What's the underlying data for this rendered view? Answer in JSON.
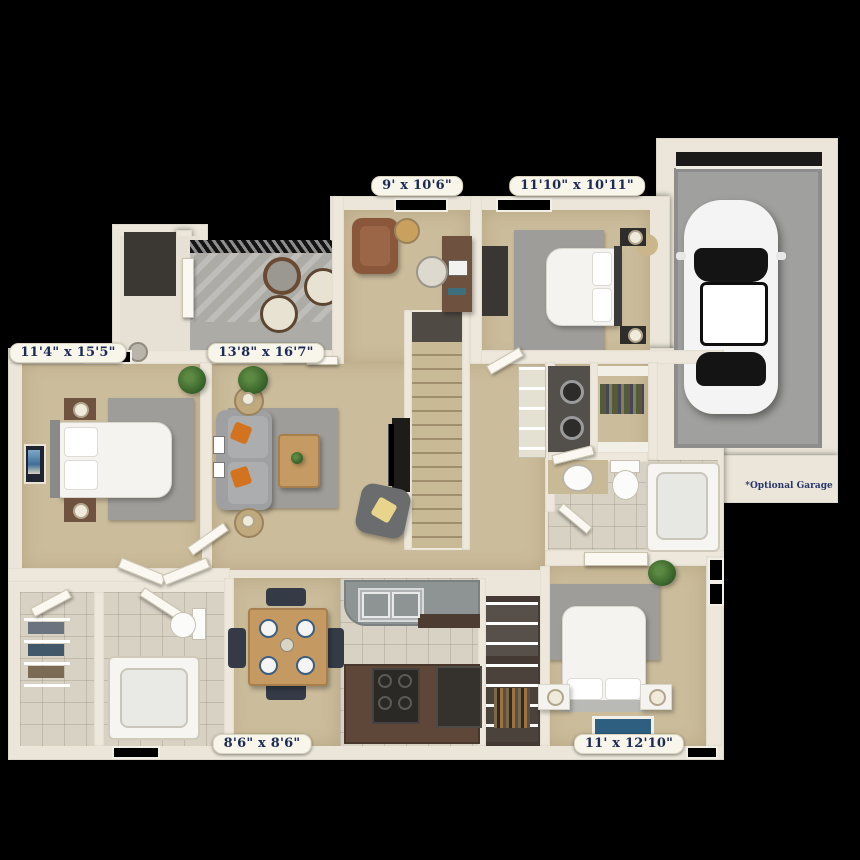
{
  "scene": {
    "type": "3d-apartment-floor-plan",
    "background": "#000000"
  },
  "labels": {
    "loft": "9' x 10'6\"",
    "bedroom2": "11'10\" x 10'11\"",
    "master_bedroom": "11'4\" x 15'5\"",
    "living_room": "13'8\" x 16'7\"",
    "kitchen": "8'6\" x 8'6\"",
    "bedroom3": "11' x 12'10\"",
    "garage_note": "*Optional Garage"
  },
  "colors": {
    "background": "#000000",
    "wall": "#EBE6D9",
    "carpet": "#CBBC9B",
    "rug": "#9E9D99",
    "tile": "#D8D2C4",
    "patio_floor": "#ACABA6",
    "garage_floor": "#A0A09E",
    "cabinet_brown": "#5E4739",
    "counter_gray": "#8E9393",
    "accent_orange": "#D4731F",
    "label_text": "#1C2B55",
    "label_background": "#F8F5EA"
  }
}
